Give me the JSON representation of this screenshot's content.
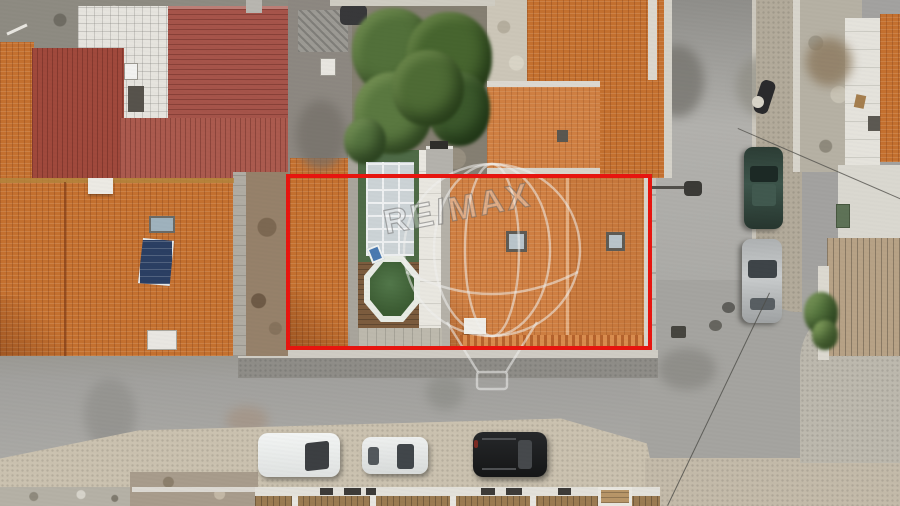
{
  "image": {
    "kind": "aerial-drone-photo",
    "subject": "terraced house with inner courtyard, outlined in red for a property listing",
    "width_px": 900,
    "height_px": 506
  },
  "watermark": {
    "text": "RE/MAX",
    "shape": "hot-air-balloon-outline",
    "rotation_deg": -11
  },
  "annotation": {
    "name": "property-outline",
    "color": "#e8150f",
    "x": 286,
    "y": 174,
    "width": 366,
    "height": 176
  },
  "colors": {
    "outline-red": "#e8150f",
    "roof-orange-subject": "#cf7f42",
    "roof-orange-neighbor": "#c4702f",
    "roof-maroon": "#a6544a",
    "pool-green": "#3c5c33",
    "awning-green": "#4f6b47",
    "deck-brown": "#7c5c3e",
    "street-gray": "#a3a2a0",
    "sidewalk-beige": "#cbc2b0",
    "tree-green": "#4e6a36"
  },
  "scene": {
    "property_features": [
      "large orange tiled roof with two skylights",
      "white rooftop chimney",
      "green-framed glass awning over patio",
      "octagonal above-ground pool with dark green cover",
      "wooden deck in courtyard",
      "blue pool ladder"
    ],
    "surroundings": [
      "dark red corrugated roofs upper left",
      "white tiled terrace upper left",
      "rear garden with large tree canopy",
      "neighboring orange roof with solar water-heater panel and skylight",
      "ruined stone walls upper right",
      "wooden platform and palm shrub on right sidewalk",
      "row of small roofs along bottom edge"
    ],
    "streets": [
      "horizontal street across bottom",
      "vertical street on right",
      "T-intersection with curved curbs",
      "overhead utility cables",
      "street lamp on arm over right street"
    ],
    "vehicles": [
      {
        "name": "white-van",
        "color": "white",
        "location": "bottom street, parked"
      },
      {
        "name": "white-hatchback",
        "color": "white",
        "location": "bottom street, parked"
      },
      {
        "name": "black-suv",
        "color": "black",
        "location": "bottom street, parked"
      },
      {
        "name": "dark-green-car",
        "color": "dark green",
        "location": "right street, parked"
      },
      {
        "name": "silver-car",
        "color": "silver",
        "location": "right street, parked"
      },
      {
        "name": "motorcycle",
        "color": "black",
        "location": "right sidewalk"
      }
    ]
  }
}
